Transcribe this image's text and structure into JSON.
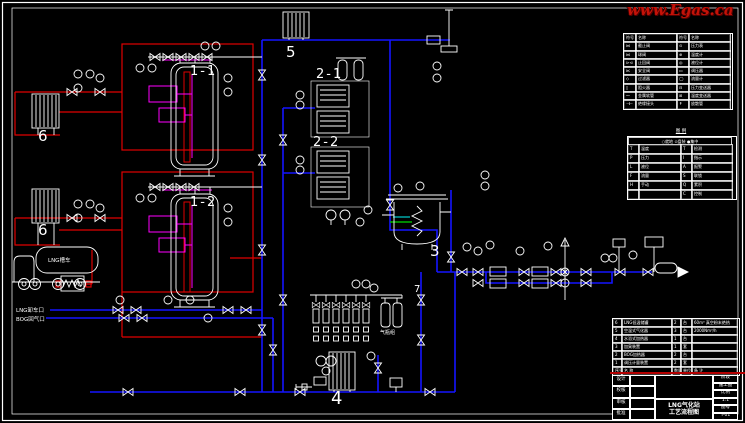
{
  "watermark": {
    "text": "www.Egas.ca"
  },
  "colors": {
    "background": "#000000",
    "equipment_white": "#ffffff",
    "gas_pipe_blue": "#1414ff",
    "liquid_pipe_red": "#e00000",
    "instrument_signal_magenta": "#ff00ff",
    "aux_green": "#00b400",
    "aux_cyan": "#00c8c8",
    "watermark_red": "#c41208"
  },
  "equipment_labels": {
    "tank1": "1-1",
    "tank2": "1-2",
    "unit21": "2-1",
    "unit22": "2-2",
    "odorizer": "3",
    "vaporizer4": "4",
    "heater5": "5",
    "vaporizer6a": "6",
    "vaporizer6b": "6",
    "junction7": "7"
  },
  "texts": {
    "truck": "LNG槽车",
    "unloading_port": "LNG卸车口",
    "bog_return_port": "BOG回气口",
    "cylinder_group": "气瓶组"
  },
  "legend_table": {
    "rows": [
      {
        "s1": "符号",
        "n1": "名称",
        "s2": "符号",
        "n2": "名称"
      },
      {
        "s1": "⋈",
        "n1": "截止阀",
        "s2": "⊙",
        "n2": "压力表"
      },
      {
        "s1": "⋈",
        "n1": "球阀",
        "s2": "⊕",
        "n2": "温度计"
      },
      {
        "s1": "⊳⊲",
        "n1": "止回阀",
        "s2": "◎",
        "n2": "液位计"
      },
      {
        "s1": "⋉",
        "n1": "安全阀",
        "s2": "▭",
        "n2": "调压器"
      },
      {
        "s1": "◇",
        "n1": "过滤器",
        "s2": "◯",
        "n2": "流量计"
      },
      {
        "s1": "▯",
        "n1": "阻火器",
        "s2": "⊟",
        "n2": "压力变送器"
      },
      {
        "s1": "〜",
        "n1": "金属软管",
        "s2": "⊞",
        "n2": "温度变送器"
      },
      {
        "s1": "⊣⊢",
        "n1": "绝缘接头",
        "s2": "↟",
        "n2": "放散管"
      }
    ]
  },
  "letter_table": {
    "title": "图 例",
    "header": "○就地  ⊙盘装  ●集中",
    "rows": [
      {
        "l": "T",
        "ld": "温度",
        "r": "T",
        "rd": "检测"
      },
      {
        "l": "P",
        "ld": "压力",
        "r": "I",
        "rd": "指示"
      },
      {
        "l": "L",
        "ld": "液位",
        "r": "A",
        "rd": "报警"
      },
      {
        "l": "F",
        "ld": "流量",
        "r": "S",
        "rd": "联锁"
      },
      {
        "l": "H",
        "ld": "手动",
        "r": "Q",
        "rd": "累积"
      },
      {
        "l": "",
        "ld": "",
        "r": "C",
        "rd": "控制"
      }
    ]
  },
  "bom_table": {
    "rows": [
      {
        "no": "6",
        "name": "LNG低温储罐",
        "qty": "2",
        "unit": "台",
        "remark": "60m³ 真空粉末绝热"
      },
      {
        "no": "5",
        "name": "空温式气化器",
        "qty": "3",
        "unit": "台",
        "remark": "2000Nm³/h"
      },
      {
        "no": "4",
        "name": "水浴式加热器",
        "qty": "1",
        "unit": "台",
        "remark": ""
      },
      {
        "no": "3",
        "name": "加臭装置",
        "qty": "1",
        "unit": "套",
        "remark": ""
      },
      {
        "no": "2",
        "name": "BOG加热器",
        "qty": "2",
        "unit": "台",
        "remark": ""
      },
      {
        "no": "1",
        "name": "调压计量装置",
        "qty": "2",
        "unit": "套",
        "remark": ""
      },
      {
        "no": "序号",
        "name": "名  称",
        "qty": "数量",
        "unit": "单位",
        "remark": "备  注"
      }
    ]
  },
  "title_block": {
    "roles": [
      "设计",
      "校核",
      "审核",
      "批准"
    ],
    "name1": "LNG气化站",
    "name2": "工艺流程图",
    "right": [
      "阶段",
      "施工图",
      "比例",
      "1:1",
      "图号",
      "Y-01"
    ]
  }
}
